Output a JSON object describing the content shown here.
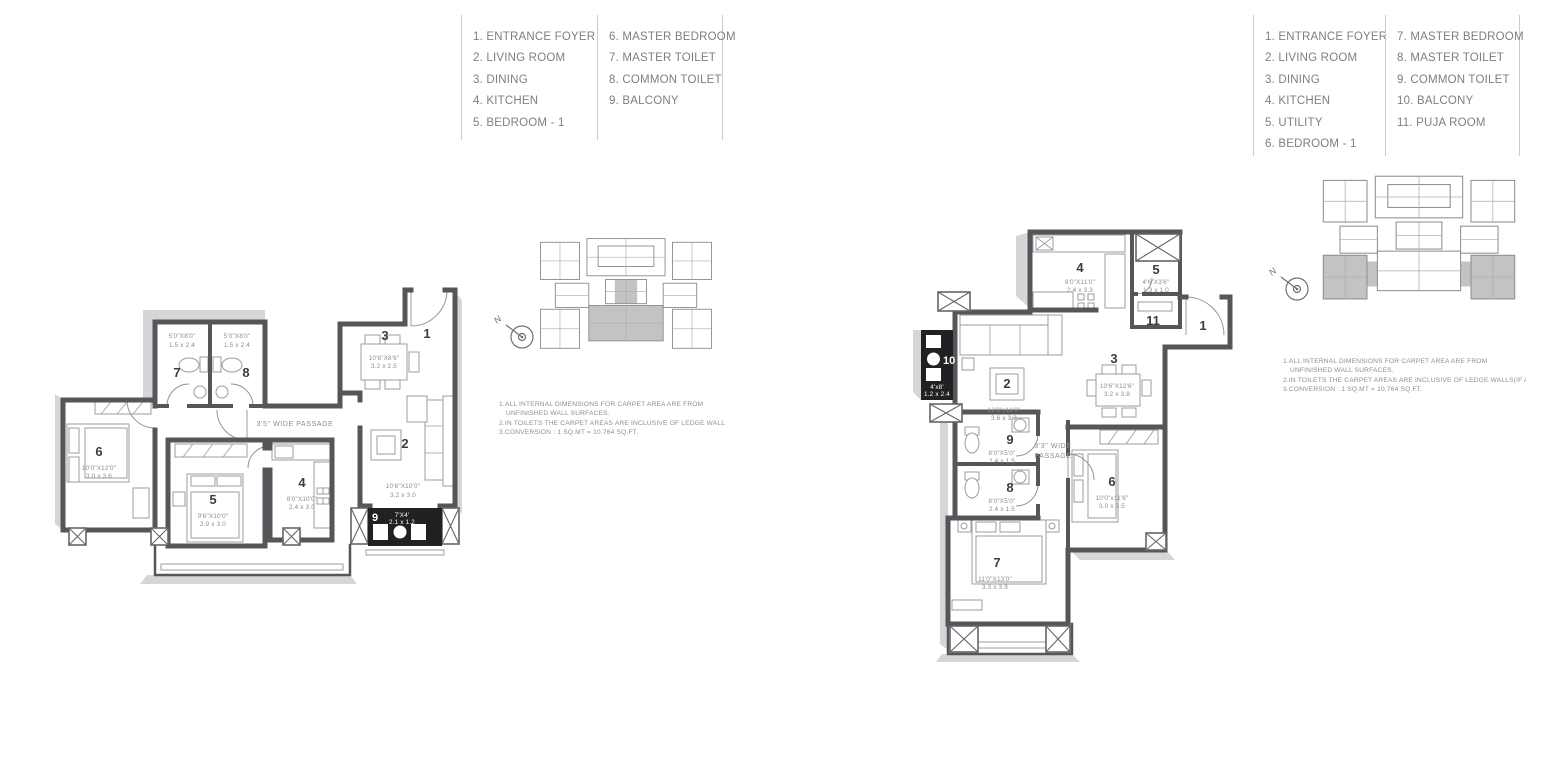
{
  "plans": [
    {
      "legend": {
        "col1": [
          "1. ENTRANCE FOYER",
          "2. LIVING ROOM",
          "3. DINING",
          "4. KITCHEN",
          "5. BEDROOM - 1"
        ],
        "col2": [
          "6. MASTER BEDROOM",
          "7. MASTER TOILET",
          "8. COMMON TOILET",
          "9. BALCONY"
        ]
      },
      "rooms": {
        "r1": {
          "num": "1"
        },
        "r2": {
          "num": "2",
          "ft": "10'6\"X10'0\"",
          "m": "3.2 x 3.0"
        },
        "r3": {
          "num": "3",
          "ft": "10'6\"X8'6\"",
          "m": "3.2 x 2.5"
        },
        "r4": {
          "num": "4",
          "ft": "8'0\"X10'0\"",
          "m": "2.4 x 3.0"
        },
        "r5": {
          "num": "5",
          "ft": "9'6\"X10'0\"",
          "m": "2.9 x 3.0"
        },
        "r6": {
          "num": "6",
          "ft": "10'0\"X12'0\"",
          "m": "3.0 x 3.6"
        },
        "r7": {
          "num": "7",
          "ft": "5'0\"X8'0\"",
          "m": "1.5 x 2.4"
        },
        "r8": {
          "num": "8",
          "ft": "5'0\"X8'0\"",
          "m": "1.5 x 2.4"
        },
        "r9": {
          "num": "9",
          "ft": "7'X4'",
          "m": "2.1 x 1.2"
        }
      },
      "passage": "3'5\" WIDE PASSAGE",
      "north": "N",
      "notes": {
        "l1": "1.ALL INTERNAL DIMENSIONS FOR CARPET AREA ARE FROM",
        "l2": "UNFINISHED WALL SURFACES.",
        "l3": "2.IN TOILETS THE CARPET AREAS ARE INCLUSIVE OF LEDGE WALLS(IF ANY)",
        "l4": "3.CONVERSION : 1 SQ.MT = 10.764 SQ.FT."
      }
    },
    {
      "legend": {
        "col1": [
          "1. ENTRANCE FOYER",
          "2. LIVING ROOM",
          "3. DINING",
          "4. KITCHEN",
          "5. UTILITY",
          "6. BEDROOM - 1"
        ],
        "col2": [
          "7. MASTER BEDROOM",
          "8. MASTER TOILET",
          "9. COMMON TOILET",
          "10. BALCONY",
          "11. PUJA ROOM"
        ]
      },
      "rooms": {
        "r1": {
          "num": "1"
        },
        "r2": {
          "num": "2",
          "ft": "12'0\"x11'0\"",
          "m": "3.6 x 3.3"
        },
        "r3": {
          "num": "3",
          "ft": "10'6\"X12'6\"",
          "m": "3.2 x 3.8"
        },
        "r4": {
          "num": "4",
          "ft": "8'0\"X11'0\"",
          "m": "2.4 x 3.3"
        },
        "r5": {
          "num": "5",
          "ft": "4'6\"X3'6\"",
          "m": "1.3 x 1.0"
        },
        "r6": {
          "num": "6",
          "ft": "10'0\"x11'6\"",
          "m": "3.0 x 3.5"
        },
        "r7": {
          "num": "7",
          "ft": "11'0\"X13'0\"",
          "m": "3.3 x 3.9"
        },
        "r8": {
          "num": "8",
          "ft": "8'0\"X5'0\"",
          "m": "2.4 x 1.5"
        },
        "r9": {
          "num": "9",
          "ft": "8'0\"X5'0\"",
          "m": "2.4 x 1.5"
        },
        "r10": {
          "num": "10",
          "ft": "4'x8'",
          "m": "1.2 x 2.4"
        },
        "r11": {
          "num": "11"
        }
      },
      "passage_l1": "3'3\" WIDE",
      "passage_l2": "PASSAGE",
      "north": "N",
      "notes": {
        "l1": "1.ALL INTERNAL DIMENSIONS FOR CARPET AREA ARE FROM",
        "l2": "UNFINISHED WALL SURFACES.",
        "l3": "2.IN TOILETS THE CARPET AREAS ARE INCLUSIVE OF LEDGE WALLS(IF ANY)",
        "l4": "3.CONVERSION : 1 SQ.MT = 10.764 SQ.FT."
      }
    }
  ]
}
